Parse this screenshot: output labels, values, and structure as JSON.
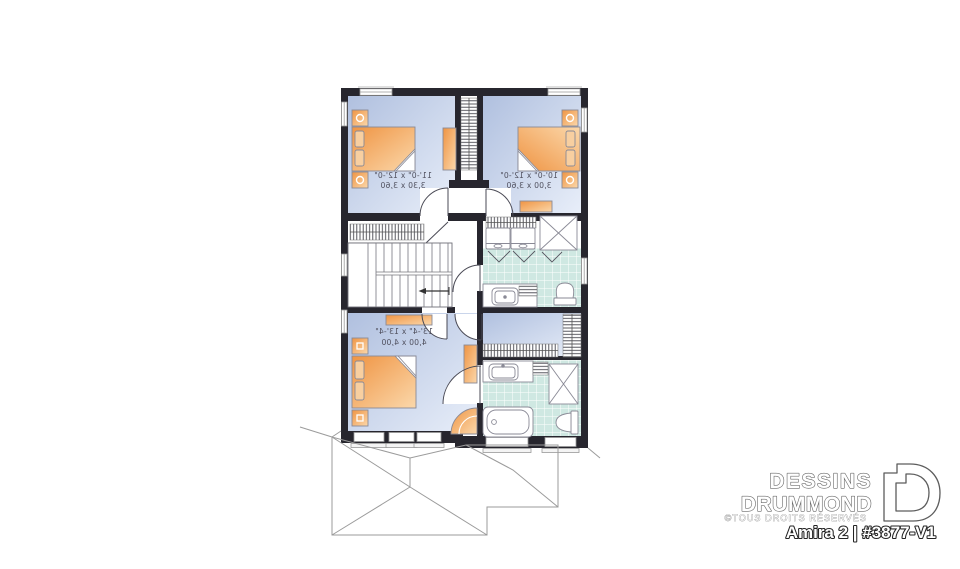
{
  "branding": {
    "name_line1": "DESSINS",
    "name_line2": "DRUMMOND",
    "copyright": "©TOUS DROITS RÉSERVÉS",
    "plan_title": "Amira 2 | #3877-V1",
    "logo_icon": "drummond-d-logo"
  },
  "plan": {
    "text_is_mirrored": true,
    "rooms": [
      {
        "name": "bedroom-top-left",
        "dims_imperial": "11'-0\" x 12'-0\"",
        "dims_metric": "3,30 x 3,60"
      },
      {
        "name": "bedroom-top-right",
        "dims_imperial": "10'-0\" x 12'-0\"",
        "dims_metric": "3,00 x 3,60"
      },
      {
        "name": "bedroom-bottom",
        "dims_imperial": "13'-4\" x 13'-4\"",
        "dims_metric": "4,00 x 4,00"
      }
    ],
    "fixtures": [
      "bed",
      "nightstand-lamp",
      "dresser",
      "armchair",
      "closet-rod",
      "staircase",
      "stairs-direction-arrow",
      "washer",
      "dryer",
      "shower",
      "bathtub",
      "toilet",
      "sink",
      "linen-shelf",
      "window",
      "door-swing",
      "roof-outline"
    ]
  },
  "colors": {
    "wall": "#27262e",
    "bedroom_floor_dark": "#b0c0df",
    "bedroom_floor_light": "#e8eef9",
    "tile_floor": "#cfe8e2",
    "furniture_orange_dark": "#ef9443",
    "furniture_orange_light": "#fbd8ab",
    "drawing_line_gray": "#8a8a96"
  }
}
